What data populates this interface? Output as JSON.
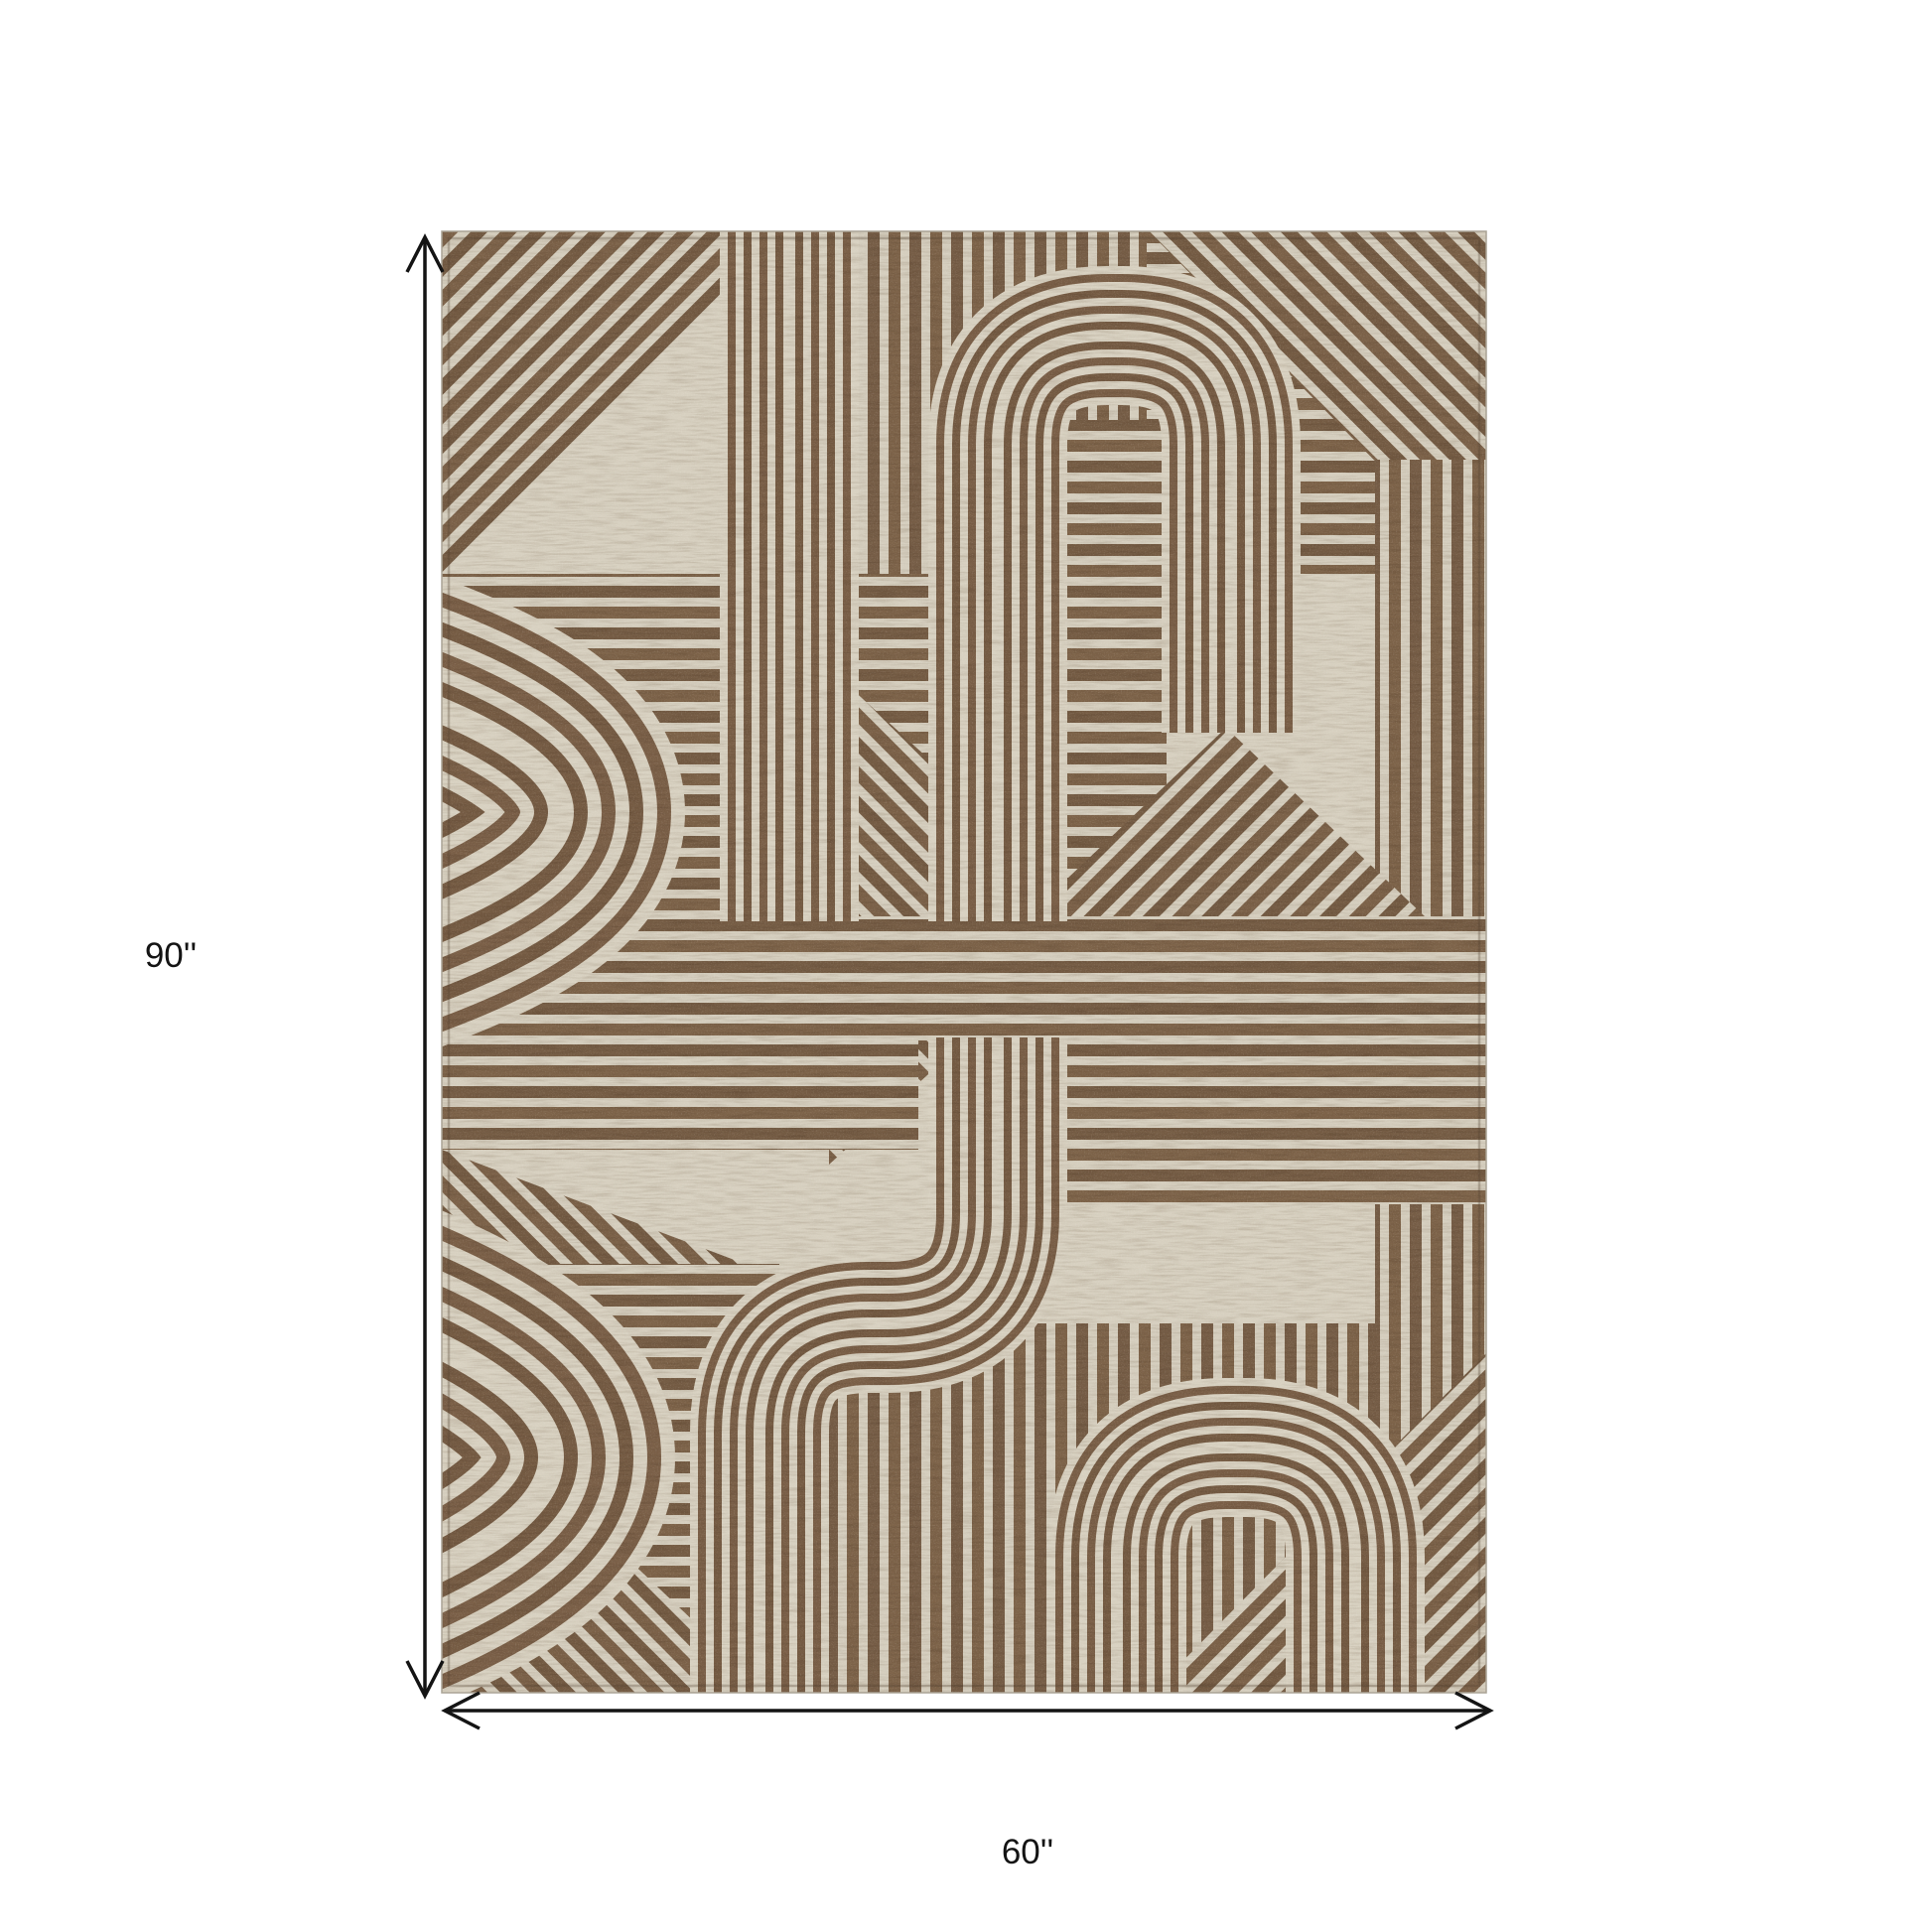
{
  "image": {
    "kind": "product-dimension-diagram",
    "subject": "Brown and taupe geometric maze-pattern area rug shown flat with dimension arrows"
  },
  "dimensions": {
    "height_label": "90''",
    "width_label": "60''"
  },
  "rug": {
    "pattern": "art-deco maze of cream pinstripe tracks, curved U-turn loops, diagonal striped triangles and horizontal bands",
    "colors": {
      "brown": "#7d6349",
      "brown_dark": "#6a523c",
      "cream": "#d7d0c0",
      "cream_light": "#ddd6c7"
    }
  },
  "annotation": {
    "arrow_color": "#141414",
    "background": "#ffffff"
  }
}
